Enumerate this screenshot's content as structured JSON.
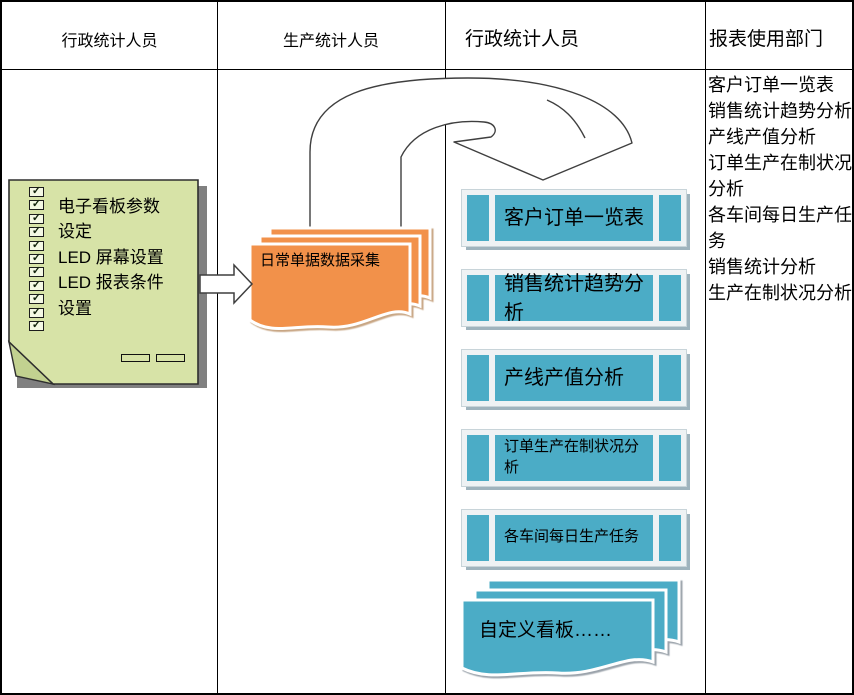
{
  "lanes": [
    {
      "label": "行政统计人员"
    },
    {
      "label": "生产统计人员"
    },
    {
      "label": "行政统计人员"
    },
    {
      "label": "报表使用部门"
    }
  ],
  "note": {
    "checkbox_count": 11,
    "check_glyph": "✓",
    "lines": [
      "电子看板参数",
      "设定",
      "LED 屏幕设置",
      "LED 报表条件",
      "设置"
    ]
  },
  "collection_doc": {
    "label": "日常单据数据采集"
  },
  "report_boxes": [
    {
      "label": "客户订单一览表",
      "size": "large"
    },
    {
      "label": "销售统计趋势分析",
      "size": "large"
    },
    {
      "label": "产线产值分析",
      "size": "large"
    },
    {
      "label": "订单生产在制状况分析",
      "size": "small"
    },
    {
      "label": "各车间每日生产任务",
      "size": "small"
    }
  ],
  "custom_board_doc": {
    "label": "自定义看板……"
  },
  "report_list": [
    "客户订单一览表",
    "销售统计趋势分析",
    "产线产值分析",
    "订单生产在制状况分析",
    "各车间每日生产任务",
    "销售统计分析",
    "生产在制状况分析"
  ],
  "colors": {
    "note_green": "#d7e3a7",
    "doc_orange": "#f2914a",
    "box_blue": "#4bacc6",
    "shadow_steel": "#9fb3bd"
  }
}
